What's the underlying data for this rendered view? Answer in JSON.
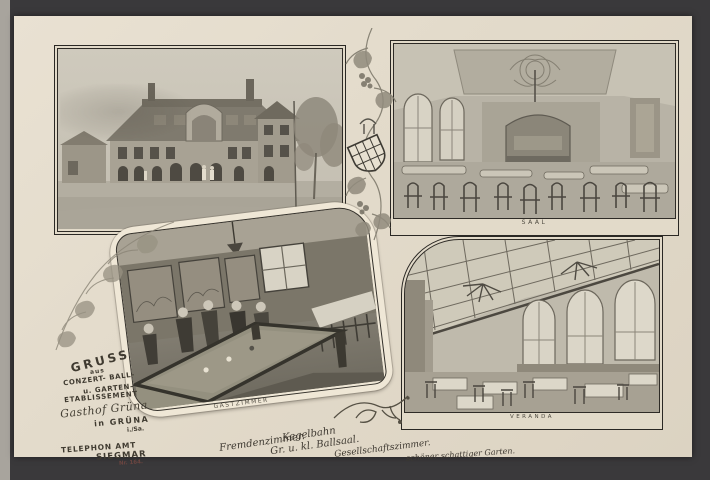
{
  "scene": {
    "type": "vintage postcard photograph, greyscale collage of a German inn",
    "background_color": "#3a393b",
    "card_color": "#e3dbcb",
    "photo_tone": "#b5b0a4",
    "ink_color": "#423d33"
  },
  "greeting": {
    "gruss": "GRUSS",
    "aus": "aus",
    "line1": "CONZERT- BALL-",
    "line2": "u. GARTEN-",
    "line3": "ETABLISSEMENT",
    "establishment_script": "Gasthof Grüna",
    "location": "in GRÜNA",
    "region": "i./Sa."
  },
  "telephone": {
    "line1": "TELEPHON AMT",
    "line2": "SIEGMAR",
    "number": "Nr. 164."
  },
  "amenities": {
    "a1": "Fremdenzimmer.",
    "a2": "Kegelbahn",
    "a3": "Gr. u. kl. Ballsaal.",
    "a4": "Gesellschaftszimmer.",
    "a5": "schöner schattiger Garten."
  },
  "photos": {
    "exterior": {
      "subject": "street view of the Gasthof building with trees"
    },
    "saal": {
      "caption": "SAAL",
      "subject": "ballroom with chandelier, stage and bentwood chairs"
    },
    "gastzimmer": {
      "caption": "GASTZIMMER",
      "subject": "tap room with billiard table and guests"
    },
    "veranda": {
      "caption": "VERANDA",
      "subject": "glass-roofed veranda with arched windows and laid tables"
    }
  }
}
